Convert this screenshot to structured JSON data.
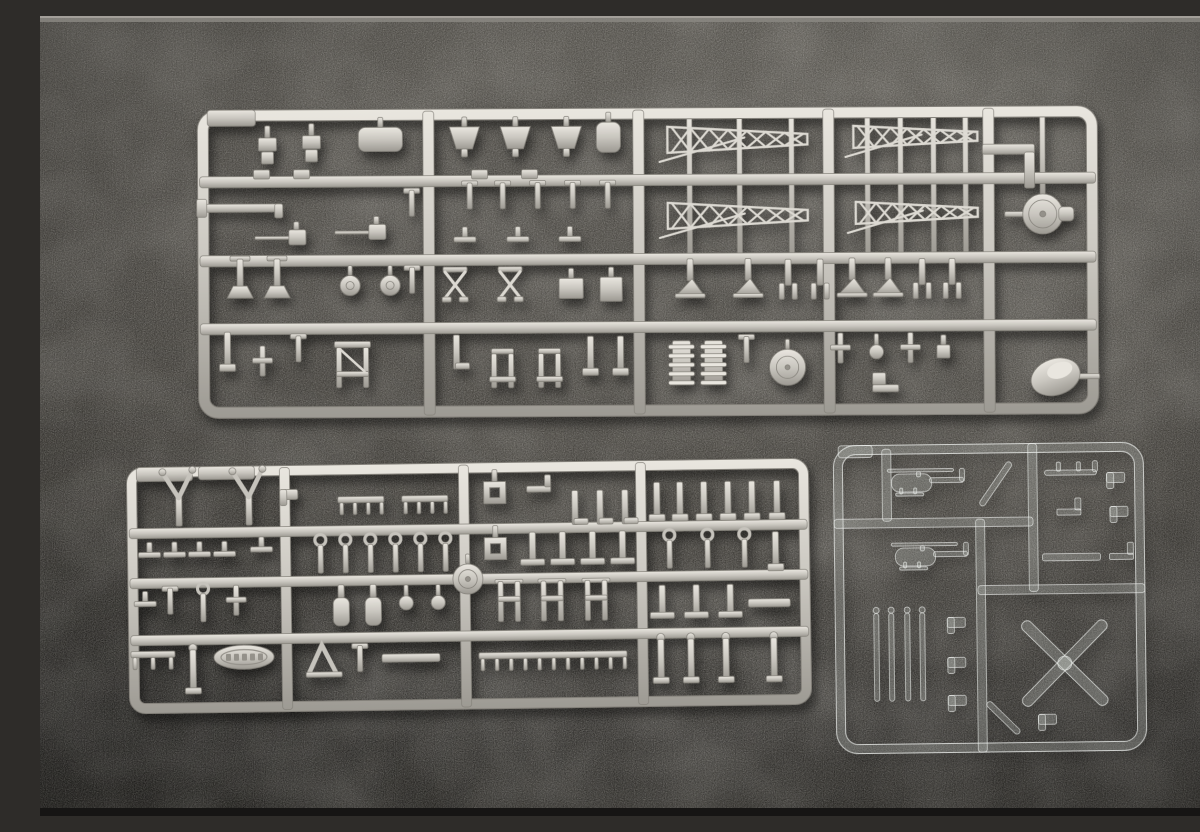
{
  "meta": {
    "type": "photograph",
    "subject": "Three injection-molded plastic model kit part sprues (runners) laid on a dark gray textured surface",
    "objects": [
      "large gray styrene sprue with ship deck fittings, gun mounts and lattice mast trusses",
      "medium gray styrene sprue with davits, bollards, vent cowls and a ship's boat",
      "small clear styrene sprue with helicopter fuselage halves, rotor blades and an X-shaped tail rotor"
    ]
  },
  "palette": {
    "background_top": "#57544f",
    "background_mid": "#474440",
    "background_low": "#3a3733",
    "background_bottom": "#2c2a27",
    "top_strip": "#8a8781",
    "bottom_strip": "#161514",
    "gray_plastic_light": "#e9e6df",
    "gray_plastic_mid": "#c6c3bc",
    "gray_plastic_dark": "#94918a",
    "gray_plastic_outline": "#84817a",
    "gray_plastic_lines": "#dcd9d2",
    "clear_fill": "rgba(228,231,228,0.18)",
    "clear_stroke": "rgba(243,245,243,0.75)"
  },
  "background": {
    "highlight_spots": [
      {
        "x": 1020,
        "y": 110,
        "r": 430,
        "a": 0.1
      },
      {
        "x": 640,
        "y": 330,
        "r": 540,
        "a": 0.06
      }
    ],
    "dark_spots": [
      {
        "x": 80,
        "y": 730,
        "r": 500,
        "a": 0.26
      }
    ]
  },
  "sprues": [
    {
      "id": "sprue-top-gray",
      "material": "gray",
      "rotation": -0.3,
      "frame": {
        "x": 158,
        "y": 92,
        "w": 900,
        "h": 308,
        "r": 20,
        "t": 11
      },
      "tabs": [
        {
          "x": 168,
          "y": 92,
          "w": 48,
          "h": 16
        }
      ],
      "v_runners": [
        389,
        599,
        789,
        949
      ],
      "h_runners": [
        164,
        243,
        311
      ],
      "rods": [
        [
          650,
          98,
          240
        ],
        [
          700,
          98,
          240
        ],
        [
          752,
          98,
          240
        ],
        [
          828,
          98,
          240
        ],
        [
          861,
          98,
          240
        ],
        [
          894,
          98,
          240
        ],
        [
          926,
          98,
          240
        ],
        [
          1003,
          98,
          184
        ]
      ],
      "parts": [
        [
          "bracket",
          228,
          133
        ],
        [
          "bracket",
          272,
          131
        ],
        [
          "roundbox",
          341,
          122,
          {
            "w": 44,
            "h": 24
          }
        ],
        [
          "foot",
          222,
          157
        ],
        [
          "foot",
          262,
          157
        ],
        [
          "trap",
          425,
          122
        ],
        [
          "trap",
          476,
          122
        ],
        [
          "trap",
          527,
          122
        ],
        [
          "roundbox",
          569,
          121,
          {
            "w": 24,
            "h": 30
          }
        ],
        [
          "foot",
          440,
          158
        ],
        [
          "foot",
          490,
          158
        ],
        [
          "angle",
          975,
          135
        ],
        [
          "elbow",
          210,
          190
        ],
        [
          "smallT",
          372,
          185
        ],
        [
          "barrel",
          245,
          220
        ],
        [
          "barrel",
          325,
          215
        ],
        [
          "smallT",
          430,
          178
        ],
        [
          "smallT",
          463,
          178
        ],
        [
          "smallT",
          498,
          178
        ],
        [
          "smallT",
          533,
          178
        ],
        [
          "smallT",
          568,
          178
        ],
        [
          "hbar",
          425,
          220
        ],
        [
          "hbar",
          478,
          220
        ],
        [
          "hbar",
          530,
          220
        ],
        [
          "lattice",
          698,
          124,
          {
            "w": 140,
            "h": 26
          }
        ],
        [
          "lattice",
          698,
          200,
          {
            "w": 140,
            "h": 26
          }
        ],
        [
          "lattice",
          876,
          122,
          {
            "w": 124,
            "h": 22
          }
        ],
        [
          "lattice",
          877,
          198,
          {
            "w": 122,
            "h": 22
          }
        ],
        [
          "turret",
          1003,
          200
        ],
        [
          "stand",
          200,
          262
        ],
        [
          "stand",
          237,
          262
        ],
        [
          "smallT",
          372,
          262
        ],
        [
          "dome",
          310,
          268
        ],
        [
          "dome",
          350,
          268
        ],
        [
          "xbrace",
          415,
          268
        ],
        [
          "xbrace",
          470,
          268
        ],
        [
          "box",
          531,
          272,
          {
            "w": 24,
            "h": 20
          }
        ],
        [
          "box",
          571,
          273,
          {
            "w": 22,
            "h": 24
          }
        ],
        [
          "astand",
          650,
          267
        ],
        [
          "astand",
          708,
          267
        ],
        [
          "fork",
          748,
          266
        ],
        [
          "fork",
          780,
          266
        ],
        [
          "astand",
          812,
          267
        ],
        [
          "astand",
          848,
          267
        ],
        [
          "fork",
          882,
          266
        ],
        [
          "fork",
          912,
          266
        ],
        [
          "post",
          187,
          332
        ],
        [
          "cross",
          222,
          344
        ],
        [
          "smallT",
          258,
          330
        ],
        [
          "yframe",
          312,
          352
        ],
        [
          "Lpost",
          416,
          334
        ],
        [
          "chair",
          462,
          352
        ],
        [
          "chair",
          509,
          352
        ],
        [
          "post",
          550,
          338
        ],
        [
          "post",
          580,
          338
        ],
        [
          "coil",
          641,
          347
        ],
        [
          "coil",
          673,
          347
        ],
        [
          "smallT",
          706,
          333
        ],
        [
          "bigdisc",
          747,
          352,
          {
            "r": 18
          }
        ],
        [
          "cross",
          800,
          334
        ],
        [
          "knob",
          836,
          337
        ],
        [
          "cross",
          870,
          334
        ],
        [
          "box",
          903,
          337,
          {
            "w": 13,
            "h": 13
          }
        ],
        [
          "step",
          845,
          372
        ],
        [
          "blob",
          1015,
          363
        ]
      ]
    },
    {
      "id": "sprue-bottom-left-gray",
      "material": "gray",
      "rotation": -0.8,
      "frame": {
        "x": 88,
        "y": 447,
        "w": 682,
        "h": 246,
        "r": 16,
        "t": 10
      },
      "tabs": [
        {
          "x": 98,
          "y": 447,
          "w": 56,
          "h": 14
        },
        {
          "x": 160,
          "y": 447,
          "w": 56,
          "h": 13
        }
      ],
      "v_runners": [
        246,
        425,
        602
      ],
      "h_runners": [
        513,
        563,
        620
      ],
      "rods": [],
      "parts": [
        [
          "vfork",
          140,
          480
        ],
        [
          "vfork",
          210,
          480
        ],
        [
          "hbar",
          110,
          532
        ],
        [
          "hbar",
          135,
          532
        ],
        [
          "hbar",
          160,
          532
        ],
        [
          "hbar",
          185,
          532
        ],
        [
          "hbar",
          222,
          528
        ],
        [
          "hbar",
          105,
          581
        ],
        [
          "smallT",
          130,
          580
        ],
        [
          "ringpost",
          163,
          585
        ],
        [
          "cross",
          196,
          582
        ],
        [
          "railing",
          112,
          634
        ],
        [
          "post2",
          152,
          652
        ],
        [
          "boat",
          203,
          638
        ],
        [
          "clip",
          250,
          476
        ],
        [
          "comb",
          322,
          482,
          {
            "w": 46
          }
        ],
        [
          "comb",
          386,
          482,
          {
            "w": 46
          }
        ],
        [
          "ringpost",
          281,
          538
        ],
        [
          "ringpost",
          306,
          538
        ],
        [
          "ringpost",
          331,
          538
        ],
        [
          "ringpost",
          356,
          538
        ],
        [
          "ringpost",
          381,
          538
        ],
        [
          "ringpost",
          406,
          538
        ],
        [
          "bottle",
          301,
          589
        ],
        [
          "bottle",
          333,
          589
        ],
        [
          "knob",
          366,
          586
        ],
        [
          "knob",
          398,
          586
        ],
        [
          "bigdisc",
          428,
          563,
          {
            "r": 15
          }
        ],
        [
          "aframe",
          283,
          642
        ],
        [
          "smallT",
          319,
          640
        ],
        [
          "bar",
          370,
          641,
          {
            "w": 58,
            "h": 8
          }
        ],
        [
          "sqring",
          456,
          477
        ],
        [
          "Lbar2",
          500,
          474
        ],
        [
          "Lpost",
          536,
          492
        ],
        [
          "Lpost",
          561,
          492
        ],
        [
          "Lpost",
          586,
          492
        ],
        [
          "sqring",
          456,
          533
        ],
        [
          "tpost",
          493,
          533
        ],
        [
          "tpost",
          523,
          533
        ],
        [
          "tpost",
          553,
          533
        ],
        [
          "tpost",
          583,
          533
        ],
        [
          "hframe",
          469,
          586
        ],
        [
          "hframe",
          512,
          586
        ],
        [
          "hframe",
          556,
          586
        ],
        [
          "comb",
          512,
          640,
          {
            "w": 148,
            "n": 11
          }
        ],
        [
          "post",
          618,
          487
        ],
        [
          "post",
          641,
          487
        ],
        [
          "post",
          665,
          487
        ],
        [
          "post",
          689,
          487
        ],
        [
          "post",
          713,
          487
        ],
        [
          "post",
          738,
          487
        ],
        [
          "ringpost",
          630,
          538
        ],
        [
          "ringpost",
          668,
          538
        ],
        [
          "ringpost",
          705,
          538
        ],
        [
          "post",
          736,
          538
        ],
        [
          "tpost",
          622,
          588
        ],
        [
          "tpost",
          656,
          588
        ],
        [
          "tpost",
          690,
          588
        ],
        [
          "bar",
          729,
          591,
          {
            "w": 42,
            "h": 8
          }
        ],
        [
          "post2",
          620,
          648
        ],
        [
          "post2",
          650,
          648
        ],
        [
          "post2",
          685,
          648
        ],
        [
          "post2",
          733,
          648
        ]
      ]
    },
    {
      "id": "sprue-clear",
      "material": "clear",
      "rotation": -0.7,
      "frame": {
        "x": 795,
        "y": 428,
        "w": 310,
        "h": 308,
        "r": 22,
        "t": 9
      },
      "tabs": [
        {
          "x": 800,
          "y": 428,
          "w": 34,
          "h": 12
        }
      ],
      "v_runners": [],
      "h_runners": [],
      "segments": {
        "v": [
          [
            994,
            428,
            576
          ],
          [
            941,
            503,
            736
          ],
          [
            848,
            432,
            504
          ]
        ],
        "h": [
          [
            506,
            795,
            994
          ],
          [
            574,
            938,
            1105
          ]
        ]
      },
      "parts": [
        [
          "heli",
          883,
          466
        ],
        [
          "heli",
          886,
          540
        ],
        [
          "diag",
          957,
          468,
          {
            "len": 52,
            "rot": -55
          }
        ],
        [
          "skid",
          1032,
          457
        ],
        [
          "clip",
          1077,
          463
        ],
        [
          "Lbar2",
          1030,
          497
        ],
        [
          "clip",
          1080,
          497
        ],
        [
          "bar",
          1032,
          542,
          {
            "w": 58,
            "h": 7
          }
        ],
        [
          "Lbar2",
          1082,
          542
        ],
        [
          "blade",
          836,
          640,
          {
            "len": 88
          }
        ],
        [
          "blade",
          851,
          640,
          {
            "len": 88
          }
        ],
        [
          "blade",
          867,
          640,
          {
            "len": 88
          }
        ],
        [
          "blade",
          882,
          640,
          {
            "len": 88
          }
        ],
        [
          "clip",
          916,
          606
        ],
        [
          "clip",
          916,
          646
        ],
        [
          "clip",
          916,
          684
        ],
        [
          "xrotor",
          1024,
          648,
          {
            "len": 116
          }
        ],
        [
          "diag",
          962,
          702,
          {
            "len": 44,
            "rot": 45
          }
        ],
        [
          "clip",
          1006,
          704
        ]
      ]
    }
  ]
}
